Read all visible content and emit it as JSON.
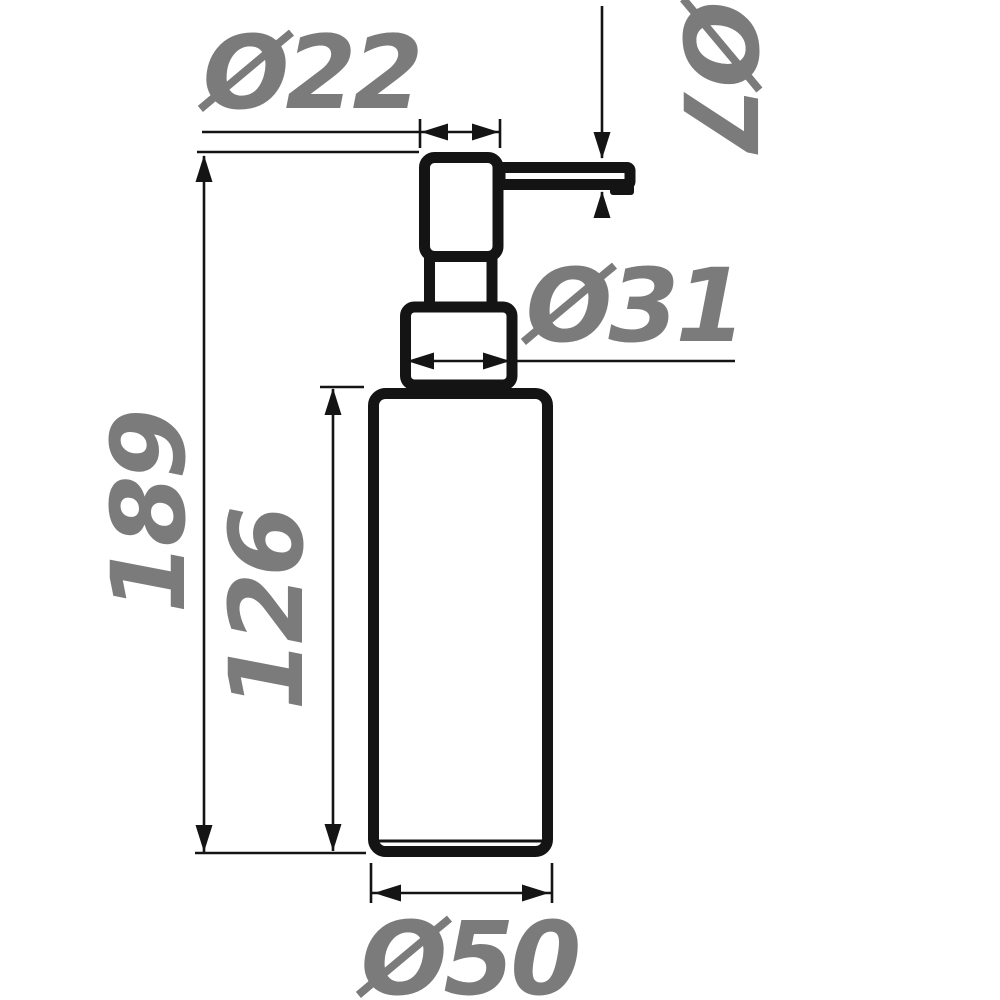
{
  "drawing": {
    "subject": "soap-dispenser-pump-bottle-technical-drawing",
    "background_color": "#ffffff",
    "outline_color": "#141414",
    "label_color": "#7b7b7b",
    "labels": {
      "head_width": "Ø22",
      "spout_diameter": "Ø7",
      "collar_width": "Ø31",
      "total_height": "189",
      "body_height": "126",
      "body_diameter": "Ø50"
    }
  }
}
